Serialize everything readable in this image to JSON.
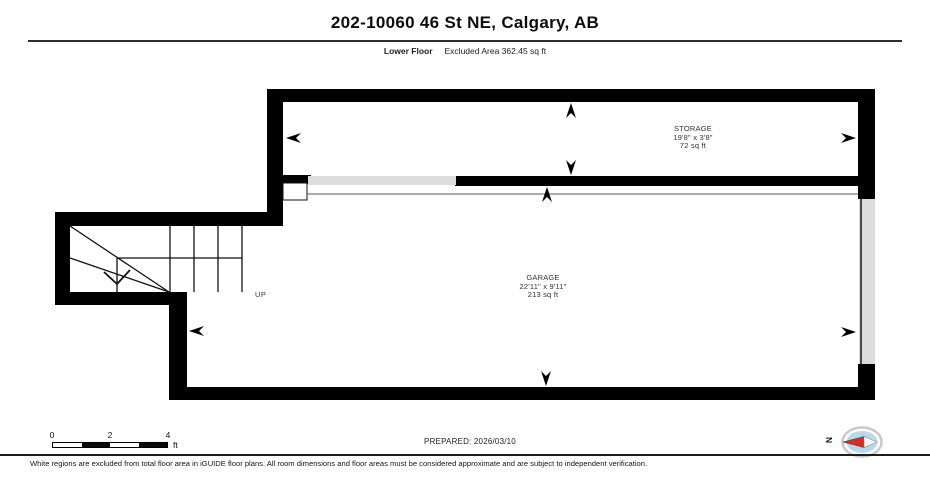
{
  "header": {
    "title": "202-10060 46 St NE, Calgary, AB",
    "floor_label": "Lower Floor",
    "excluded_area": "Excluded Area 362.45 sq ft"
  },
  "rooms": {
    "storage": {
      "name": "STORAGE",
      "dimensions": "19'8\" x 3'8\"",
      "area": "72 sq ft"
    },
    "garage": {
      "name": "GARAGE",
      "dimensions": "22'11\" x 9'11\"",
      "area": "213 sq ft"
    }
  },
  "stairs": {
    "up_label": "UP"
  },
  "scale_bar": {
    "tick_0": "0",
    "tick_2": "2",
    "tick_4": "4",
    "unit": "ft"
  },
  "prepared_label": "PREPARED: 2026/03/10",
  "compass": {
    "north_label": "N"
  },
  "footer": {
    "disclaimer": "White regions are excluded from total floor area in iGUIDE floor plans. All room dimensions and floor areas must be considered approximate and are subject to independent verification."
  },
  "colors": {
    "wall": "#000000",
    "excluded_region": "#dcdcdc",
    "thin_line": "#7a7a7a",
    "compass_fill": "#b7d9e9",
    "compass_needle": "#d42f1f"
  }
}
